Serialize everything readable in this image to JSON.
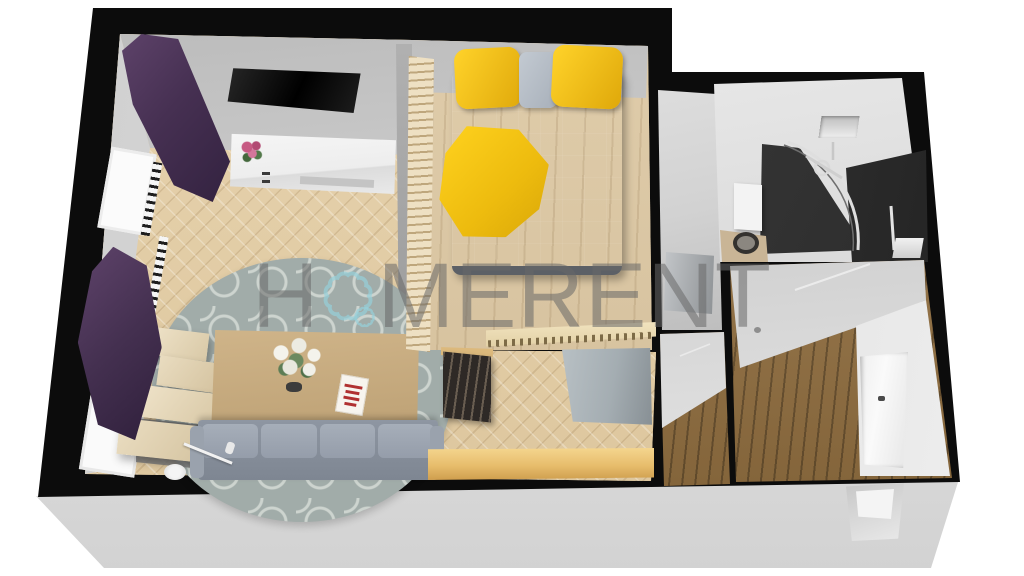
{
  "meta": {
    "description": "3D rendered top-down perspective floor plan of a one-bedroom apartment on a light gray display platform, white background",
    "render_style": "axonometric 3D dollhouse view, thick black wall outlines"
  },
  "watermark": {
    "full_text": "HOMERENT",
    "prefix": "H",
    "suffix": "MERENT",
    "logo": "scalloped-flower-ring-icon",
    "text_color": "#6e6e6e",
    "logo_color": "#9fd4dd"
  },
  "palette": {
    "walls_outline": "#0c0c0c",
    "interior_wall": "#d9d9d9",
    "parquet_tan": "#e2cda7",
    "bedroom_wood": "#d9c6a5",
    "hall_planks_brown": "#96713f",
    "platform_gray": "#e4e4e4",
    "accent_yellow": "#f2c51d",
    "curtain_purple": "#4b3354",
    "sofa_gray": "#99a1ac",
    "rug_gray": "#a1aca9",
    "table_oak": "#c8ae81"
  },
  "floorplan": {
    "rooms": [
      {
        "name": "living-room",
        "floor": "herringbone parquet",
        "items": [
          "wall-mounted-tv",
          "white-sideboard",
          "pink-flower-bouquet",
          "purple-curtain-upper",
          "purple-curtain-lower",
          "window-with-radiator-upper",
          "window-with-radiator-lower",
          "round-patterned-rug",
          "coffee-table",
          "white-lily-centerpiece",
          "book-with-red-text",
          "gray-sofa",
          "arc-floor-lamp",
          "stepped-wood-shelf"
        ]
      },
      {
        "name": "bedroom",
        "floor": "light wood",
        "items": [
          "gray-double-bed",
          "yellow-pillow-left",
          "gray-pillow-center",
          "yellow-pillow-right",
          "yellow-blanket",
          "wood-slat-partition",
          "carved-wood-rail"
        ]
      },
      {
        "name": "closet-nook",
        "floor": "gray",
        "items": [
          "gray-cabinet"
        ]
      },
      {
        "name": "bathroom",
        "floor": "mixed tile",
        "items": [
          "corner-shower-glass",
          "shower-fixture",
          "wall-niche",
          "white-wall-cabinet",
          "toilet",
          "dark-tile-panel",
          "chrome-tap"
        ]
      },
      {
        "name": "inner-hallway",
        "floor": "dark wood planks",
        "items": [
          "dark-ladder-rack",
          "gray-wardrobe",
          "wood-counter"
        ]
      },
      {
        "name": "entrance-hall",
        "floor": "dark wood planks",
        "items": [
          "entry-door",
          "door-handle",
          "ceiling-light"
        ]
      }
    ],
    "platform": {
      "color": "#e4e4e4",
      "detail": "entry threshold notch on front edge"
    }
  }
}
